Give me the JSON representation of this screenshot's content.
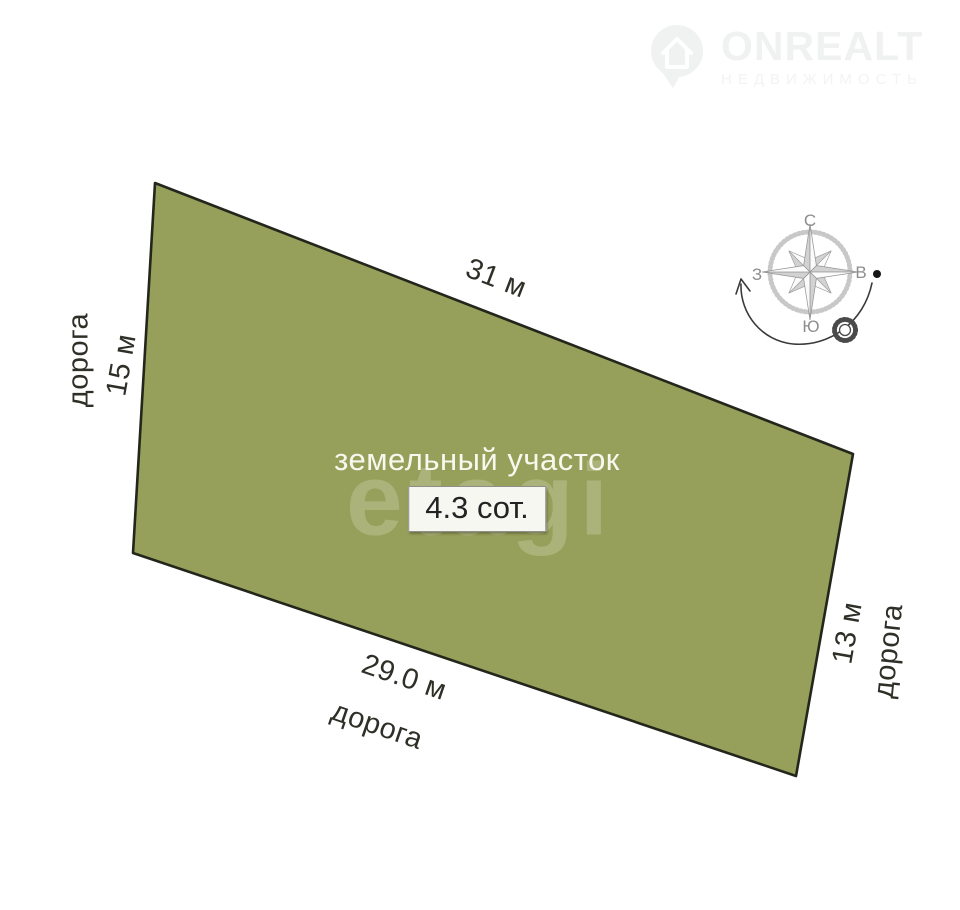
{
  "colors": {
    "plot_fill": "#97a05a",
    "plot_border": "#23261b",
    "label_text": "#2f2f28",
    "badge_bg": "#f7f7f2",
    "watermark_logo": "#f0f1f1"
  },
  "plot": {
    "title": "земельный участок",
    "area": "4.3 сот.",
    "dimensions": {
      "top": "31 м",
      "left": "15 м",
      "right": "13 м",
      "bottom": "29.0 м"
    },
    "roads": {
      "left": "дорога",
      "bottom": "дорога",
      "right": "дорога"
    }
  },
  "compass": {
    "north": "С",
    "east": "В",
    "south": "Ю",
    "west": "З"
  },
  "watermarks": {
    "center_text": "etagi",
    "brand": "ONREALT",
    "tagline": "НЕДВИЖИМОСТЬ"
  }
}
